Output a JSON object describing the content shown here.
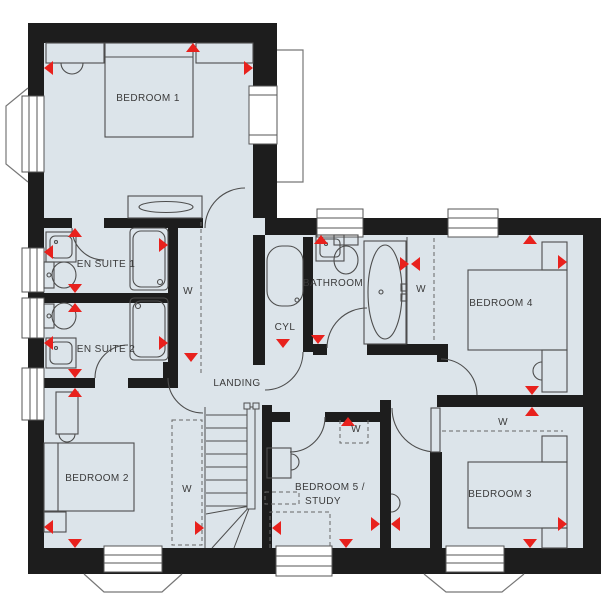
{
  "plan_type": "floor-plan",
  "colors": {
    "wall": "#1d1d1d",
    "floor": "#dce4ea",
    "marker_red": "#e8211d",
    "fixture_line": "#4d4d4d",
    "outline_thin": "#777777"
  },
  "labels": {
    "bedroom1": "BEDROOM 1",
    "bedroom2": "BEDROOM 2",
    "bedroom3": "BEDROOM 3",
    "bedroom4": "BEDROOM 4",
    "bedroom5_line1": "BEDROOM 5 /",
    "bedroom5_line2": "STUDY",
    "ensuite1": "EN SUITE 1",
    "ensuite2": "EN SUITE 2",
    "bathroom": "BATHROOM",
    "landing": "LANDING",
    "cylinder": "CYL",
    "wardrobe": "W"
  }
}
